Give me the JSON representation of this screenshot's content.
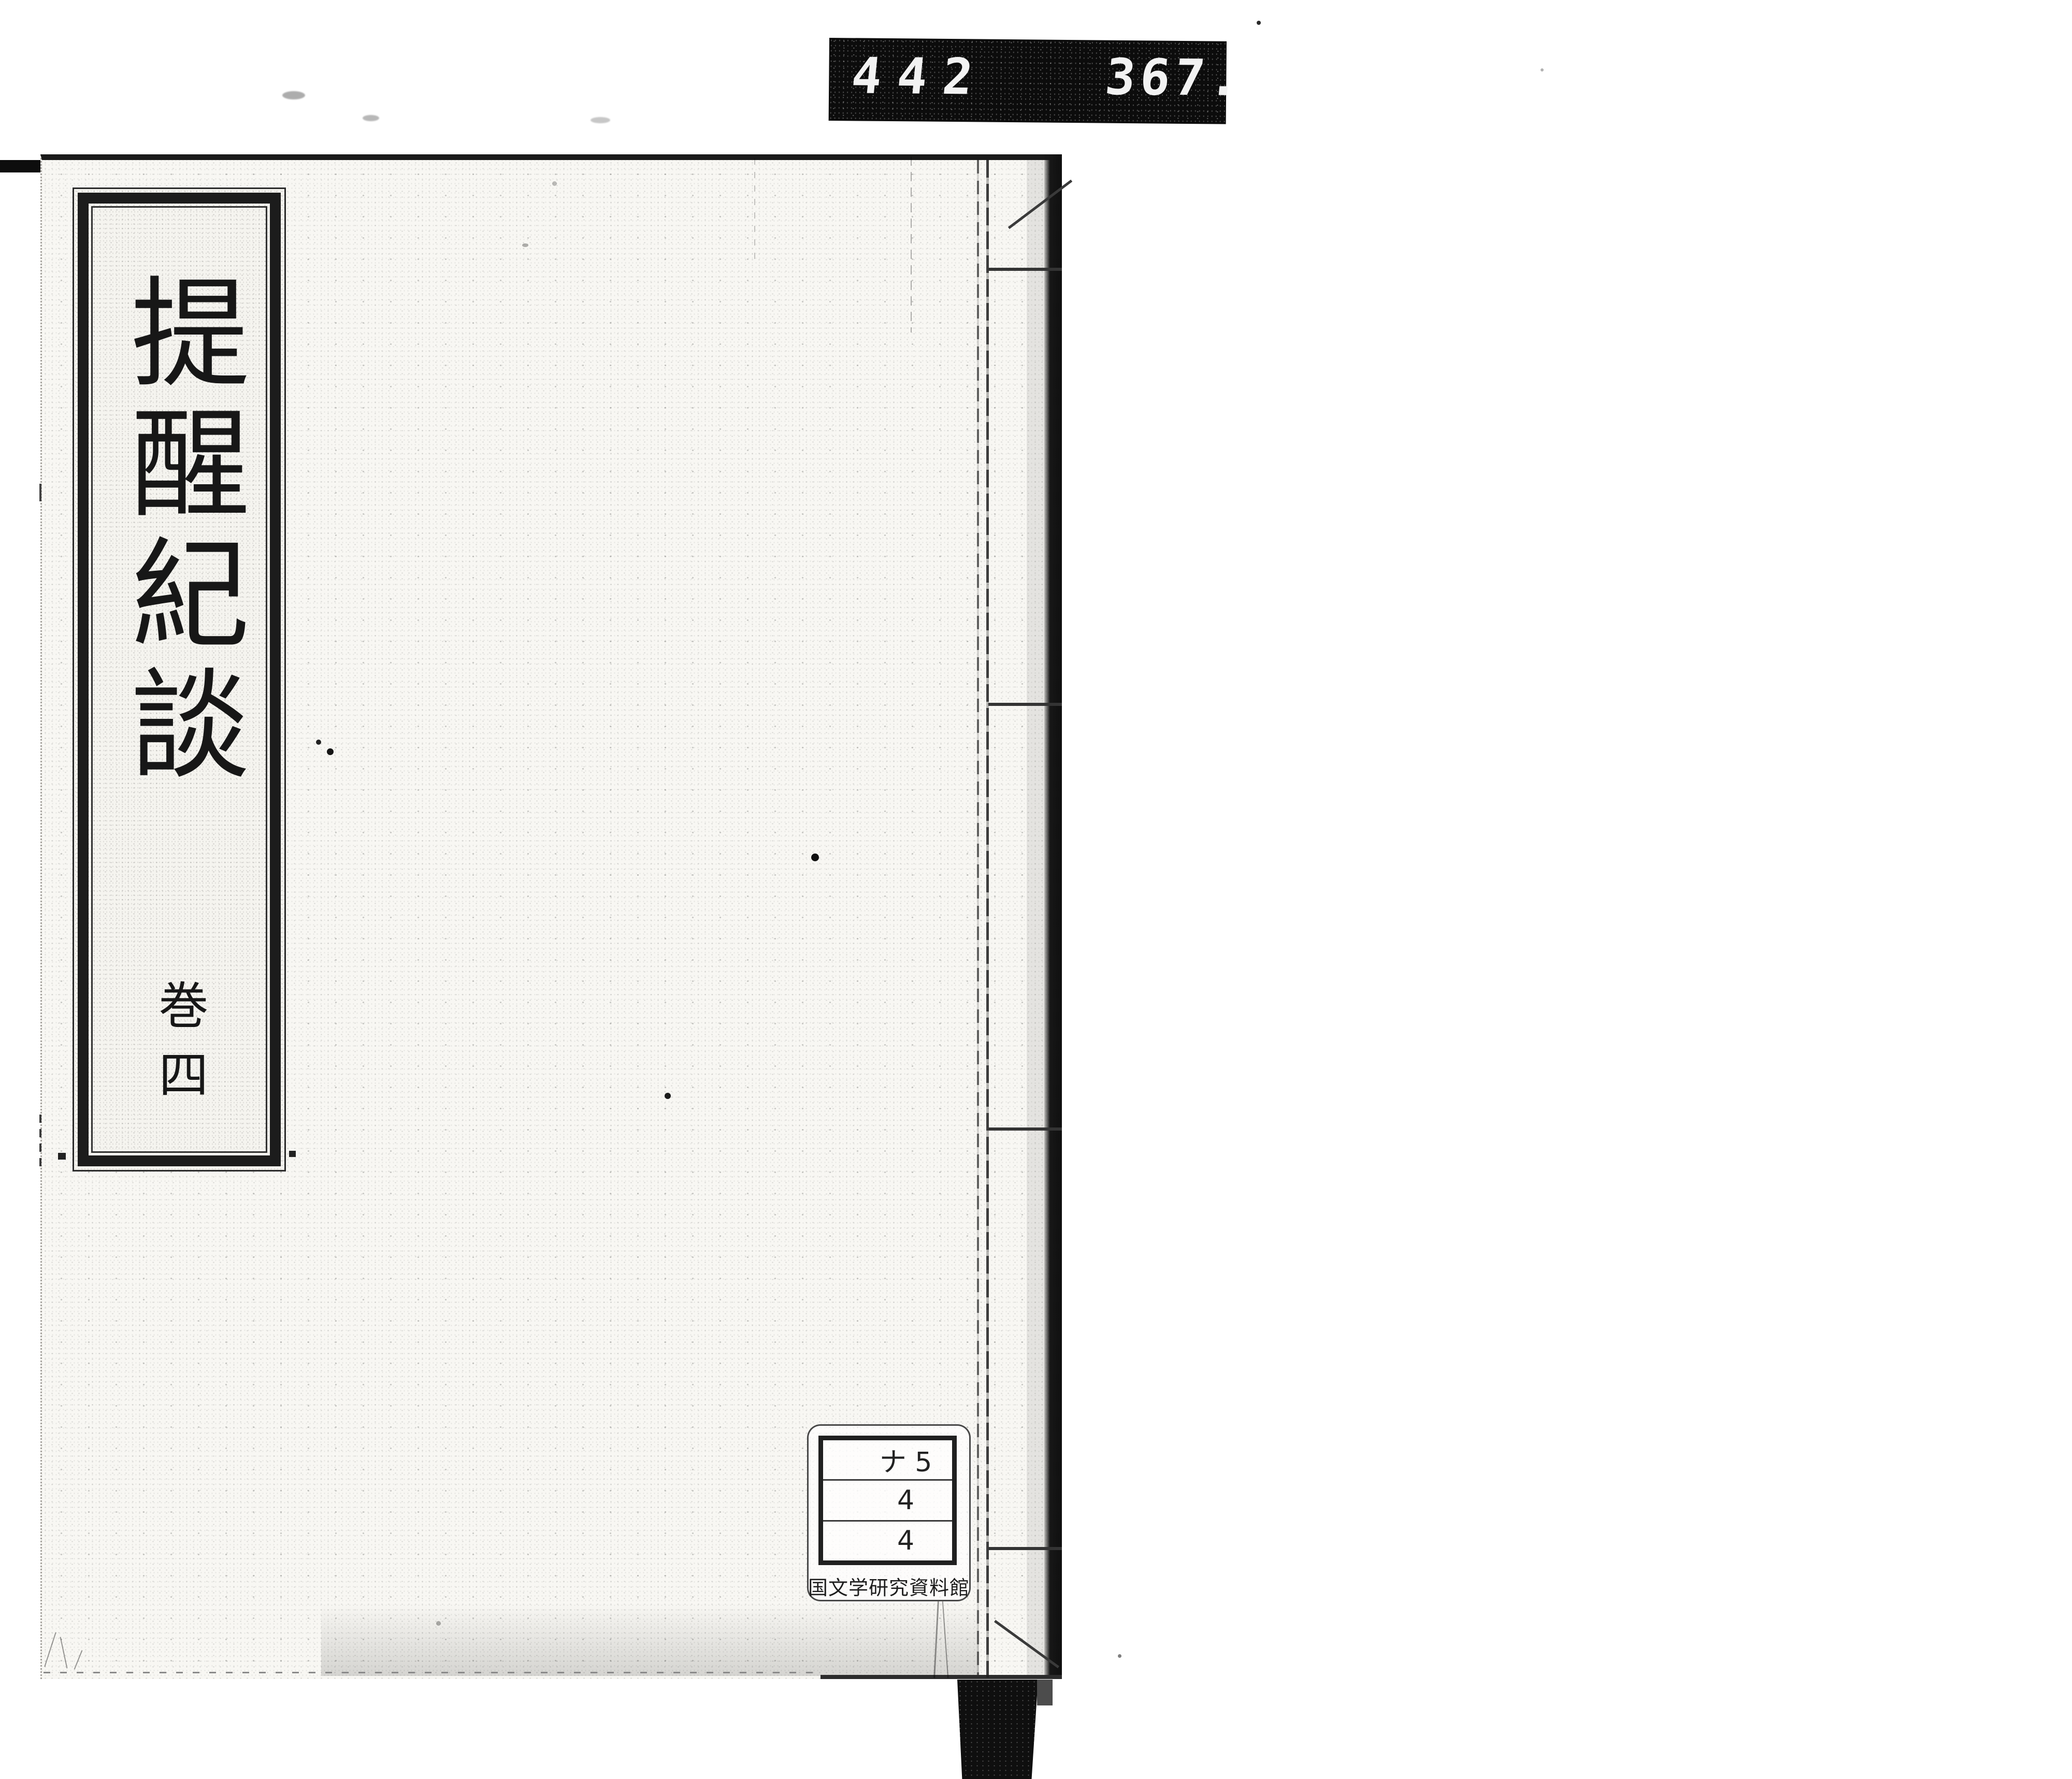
{
  "counter_bar": {
    "left_number": "442",
    "right_number": "367."
  },
  "book": {
    "title_label": {
      "title": "提醒紀談",
      "volume": "巻四"
    },
    "call_number_label": {
      "rows": [
        "ナ 5",
        "4",
        "4"
      ],
      "institution": "国文学研究資料館"
    }
  },
  "colors": {
    "ink": "#1a1a1a",
    "counter_bar_bg": "#0c0c0c",
    "counter_digits": "#f2f2f2",
    "cover_paper": "#f8f7f3"
  }
}
